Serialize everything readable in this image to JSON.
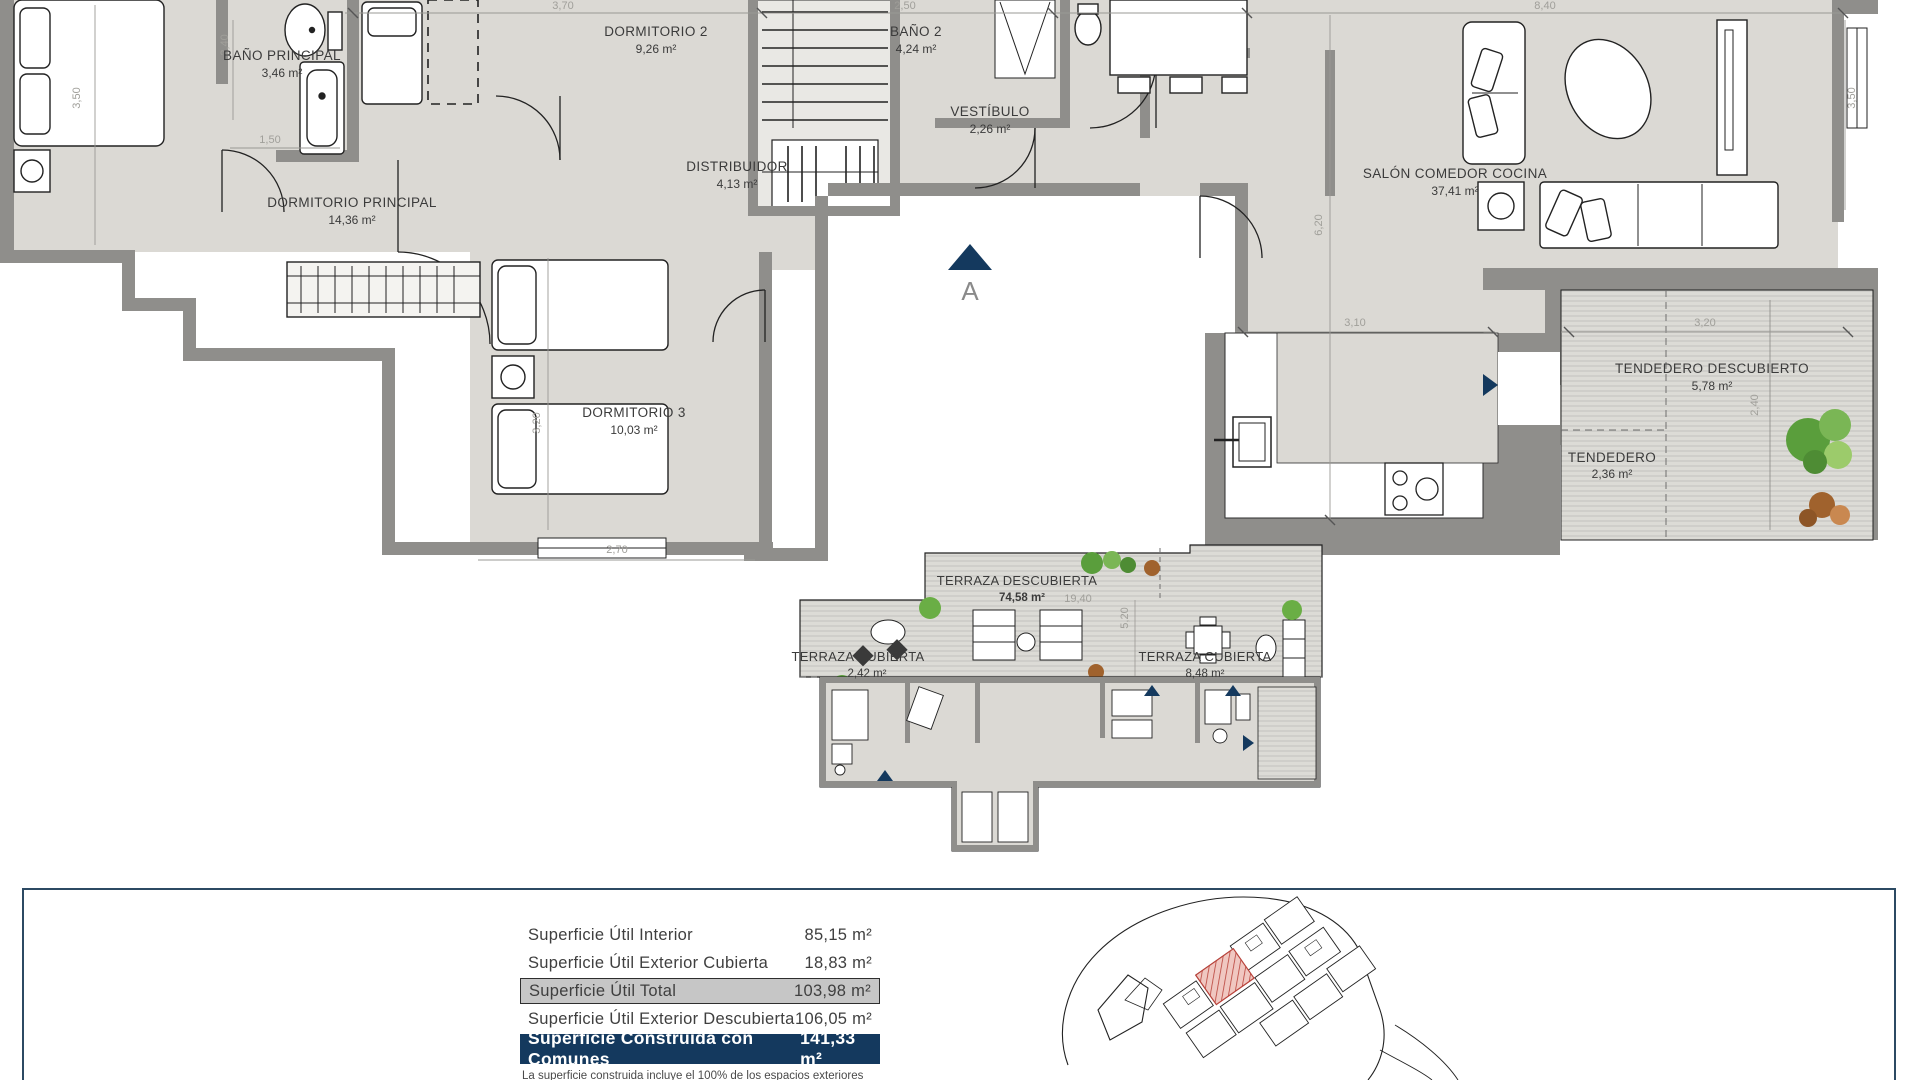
{
  "plan": {
    "rooms": {
      "bano_principal": {
        "name": "BAÑO PRINCIPAL",
        "area": "3,46 m²"
      },
      "dormitorio2": {
        "name": "DORMITORIO 2",
        "area": "9,26 m²"
      },
      "bano2": {
        "name": "BAÑO 2",
        "area": "4,24 m²"
      },
      "vestibulo": {
        "name": "VESTÍBULO",
        "area": "2,26 m²"
      },
      "distribuidor": {
        "name": "DISTRIBUIDOR",
        "area": "4,13 m²"
      },
      "dormitorio_principal": {
        "name": "DORMITORIO PRINCIPAL",
        "area": "14,36 m²"
      },
      "dormitorio3": {
        "name": "DORMITORIO 3",
        "area": "10,03 m²"
      },
      "salon": {
        "name": "SALÓN COMEDOR COCINA",
        "area": "37,41 m²"
      },
      "tendedero_descubierto": {
        "name": "TENDEDERO DESCUBIERTO",
        "area": "5,78 m²"
      },
      "tendedero": {
        "name": "TENDEDERO",
        "area": "2,36 m²"
      }
    },
    "dims": {
      "v350_left": "3,50",
      "v240_bano": "2,40",
      "h150_bano": "1,50",
      "h370": "3,70",
      "h250": "2,50",
      "h840": "8,40",
      "v350_right": "3,50",
      "v620": "6,20",
      "h310": "3,10",
      "h320_tend": "3,20",
      "v240_tend": "2,40",
      "v320_dorm3": "3,20",
      "h270_dorm3": "2,70"
    },
    "section_marker": "A"
  },
  "key_plan": {
    "rooms": {
      "terraza_descubierta": {
        "name": "TERRAZA DESCUBIERTA",
        "area": "74,58 m²"
      },
      "terraza_cubierta_1": {
        "name": "TERRAZA CUBIERTA",
        "area": "2,42 m²"
      },
      "terraza_cubierta_2": {
        "name": "TERRAZA CUBIERTA",
        "area": "8,48 m²"
      }
    },
    "dims": {
      "h1940": "19,40",
      "v520": "5,20"
    }
  },
  "summary": {
    "rows": [
      {
        "label": "Superficie Útil Interior",
        "value": "85,15 m²"
      },
      {
        "label": "Superficie Útil Exterior Cubierta",
        "value": "18,83 m²"
      },
      {
        "label": "Superficie Útil Total",
        "value": "103,98 m²"
      },
      {
        "label": "Superficie Útil Exterior Descubierta",
        "value": "106,05 m²"
      },
      {
        "label": "Superficie Construida con Comunes",
        "value": "141,33 m²"
      }
    ],
    "footnote": "La superficie construida incluye el 100% de los espacios exteriores cubiertos"
  },
  "colors": {
    "navy": "#14395e",
    "gray_row": "#c6c6c6",
    "wall": "#8f8e8b",
    "floor": "#dbd9d4",
    "highlight_red": "#b9423a",
    "plant_green": "#5a9e3c"
  }
}
